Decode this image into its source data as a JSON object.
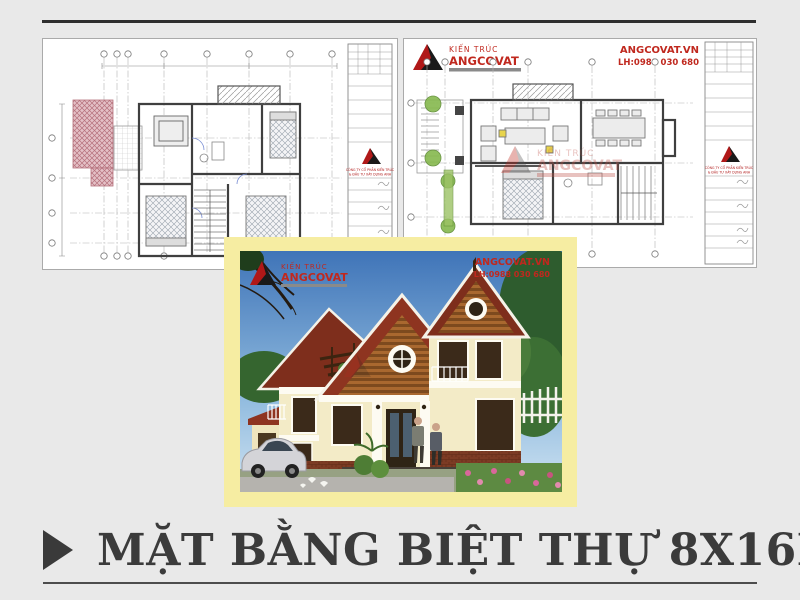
{
  "brand": {
    "logo_text_top": "KIẾN TRÚC",
    "logo_text_name": "ANGCOVAT",
    "website": "ANGCOVAT.VN",
    "contact": "LH:0988 030 680"
  },
  "title_block": {
    "company_line1": "CÔNG TY CỔ PHẦN KIẾN TRÚC",
    "company_line2": "& ĐẦU TƯ XÂY DỰNG ANH"
  },
  "watermark": {
    "line1": "KIẾN TRÚC",
    "line2": "ANGCOVAT"
  },
  "footer": {
    "title": "MẶT BẰNG BIỆT THỰ 8X16M"
  },
  "colors": {
    "accent_red": "#c0281e",
    "frame_yellow": "#f6eda2",
    "roof_red": "#8e3420",
    "hatch_pink": "#b5707b",
    "plan_green": "#86b94e",
    "background": "#e9e9e9",
    "title_text": "#3b3b3b"
  }
}
